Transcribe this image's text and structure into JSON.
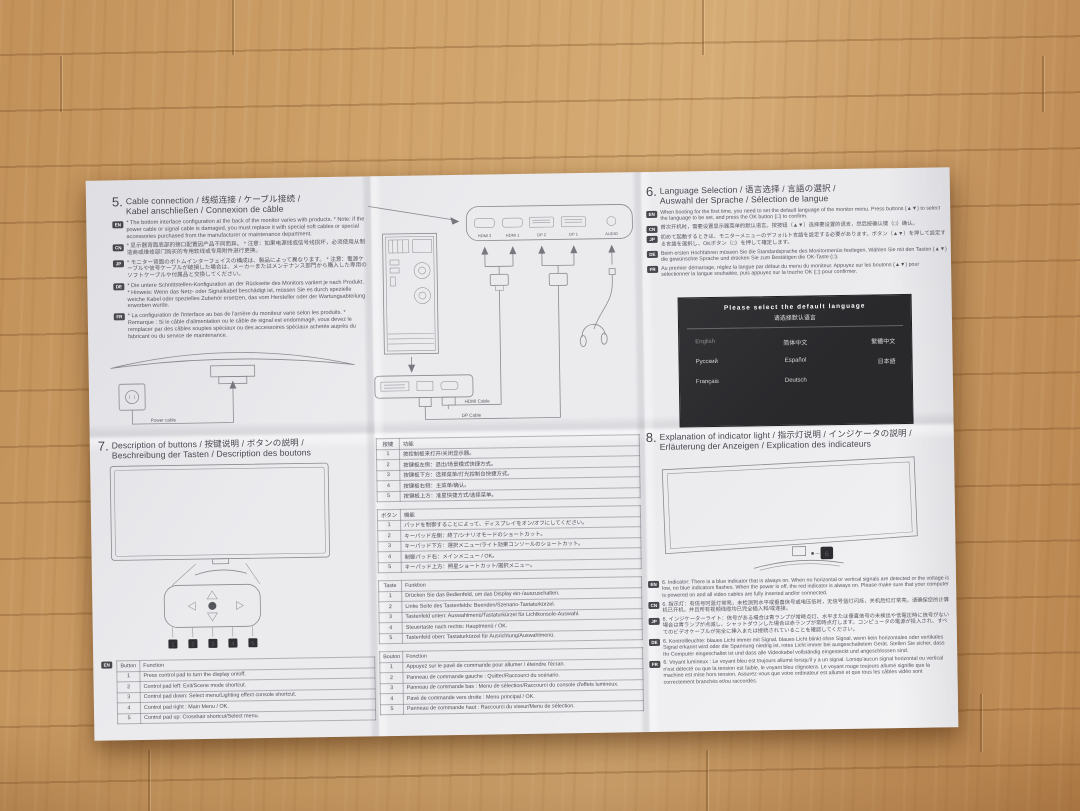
{
  "colors": {
    "wood": "#c79a63",
    "paper": "#ebebee",
    "ink": "#55555e",
    "screen_bg": "#2b2b2d",
    "badge_bg": "#47474d"
  },
  "sections": {
    "cable": {
      "num": "5.",
      "title1": "Cable connection / 线缆连接 / ケーブル接続 /",
      "title2": "Kabel anschließen / Connexion de câble",
      "paragraphs": [
        {
          "lang": "EN",
          "text": "* The bottom interface configuration at the back of the monitor varies with products. * Note: if the power cable or signal cable is damaged, you must replace it with special soft cables or special accessories purchased from the manufacturer or maintenance department."
        },
        {
          "lang": "CN",
          "text": "* 显示器背面底部的接口配置因产品不同而异。 * 注意：如果电源线或信号线损坏，必须使用从制造商或维修部门购买的专用软线或专用附件进行更换。"
        },
        {
          "lang": "JP",
          "text": "* モニター背面のボトムインターフェイスの構成は、製品によって異なります。 * 注意：電源ケーブルや信号ケーブルが破損した場合は、メーカーまたはメンテナンス部門から購入した専用のソフトケーブルや付属品と交換してください。"
        },
        {
          "lang": "DE",
          "text": "* Die untere Schnittstellen-Konfiguration an der Rückseite des Monitors variiert je nach Produkt. * Hinweis: Wenn das Netz- oder Signalkabel beschädigt ist, müssen Sie es durch spezielle weiche Kabel oder spezielles Zubehör ersetzen, das vom Hersteller oder der Wartungsabteilung erworben wurde."
        },
        {
          "lang": "FR",
          "text": "* La configuration de l'interface au bas de l'arrière du moniteur varie selon les produits. * Remarque : Si le câble d'alimentation ou le câble de signal est endommagé, vous devez le remplacer par des câbles souples spéciaux ou des accessoires spéciaux achetés auprès du fabricant ou du service de maintenance."
        }
      ],
      "power_cable_label": "Power cable"
    },
    "diagram": {
      "ports": [
        "HDMI 2",
        "HDMI 1",
        "DP 2",
        "DP 1",
        "AUDIO"
      ],
      "hdmi_cable_label": "HDMI Cable",
      "dp_cable_label": "DP Cable"
    },
    "language": {
      "num": "6.",
      "title1": "Language Selection / 语言选择 / 言語の選択 /",
      "title2": "Auswahl der Sprache / Sélection de langue",
      "paragraphs": [
        {
          "lang": "EN",
          "text": "When booting for the first time, you need to set the default language of the monitor menu. Press buttons (▲▼) to select the language to be set, and press the OK button (□) to confirm."
        },
        {
          "lang": "CN",
          "text": "首次开机时，需要设置显示器菜单的默认语言。按按钮（▲▼）选择要设置的语言，然后按确认键（□）确认。"
        },
        {
          "lang": "JP",
          "text": "初めて起動するときは、モニターメニューのデフォルト言語を設定する必要があります。ボタン（▲▼）を押して設定する言語を選択し、OKボタン（□）を押して確定します。"
        },
        {
          "lang": "DE",
          "text": "Beim ersten Hochfahren müssen Sie die Standardsprache des Monitormenüs festlegen. Wählen Sie mit den Tasten (▲▼) die gewünschte Sprache und drücken Sie zum Bestätigen die OK-Taste (□)."
        },
        {
          "lang": "FR",
          "text": "Au premier démarrage, réglez la langue par défaut du menu du moniteur. Appuyez sur les boutons (▲▼) pour sélectionner la langue souhaitée, puis appuyez sur la touche OK (□) pour confirmer."
        }
      ],
      "screen": {
        "title_en": "Please select the default language",
        "title_cn": "请选择默认语言",
        "options": [
          "English",
          "简体中文",
          "繁體中文",
          "Русский",
          "Español",
          "日本語",
          "Français",
          "Deutsch"
        ]
      }
    },
    "buttons": {
      "num": "7.",
      "title1": "Description of buttons / 按键说明 / ボタンの説明 /",
      "title2": "Beschreibung der Tasten / Description des boutons",
      "pad_numbers": [
        "1",
        "2",
        "3",
        "4",
        "5"
      ],
      "table_en": {
        "lang": "EN",
        "col_button": "Button",
        "col_function": "Function",
        "rows": [
          {
            "n": "1",
            "f": "Press control pad to turn the display on/off."
          },
          {
            "n": "2",
            "f": "Control pad left: Exit/Scene mode shortcut."
          },
          {
            "n": "3",
            "f": "Control pad down: Select menu/Lighting effect console shortcut."
          },
          {
            "n": "4",
            "f": "Control pad right : Main Menu / OK."
          },
          {
            "n": "5",
            "f": "Control pad up: Crosshair shortcut/Select menu."
          }
        ]
      }
    },
    "tables": {
      "cn": {
        "col1": "按键",
        "col2": "功能",
        "rows": [
          {
            "n": "1",
            "f": "按控制板来打开/关闭显示器。"
          },
          {
            "n": "2",
            "f": "按键板左侧：退出/场景模式快捷方式。"
          },
          {
            "n": "3",
            "f": "按键板下方：选择菜单/灯光控制台快捷方式。"
          },
          {
            "n": "4",
            "f": "按键板右侧：主菜单/确认。"
          },
          {
            "n": "5",
            "f": "按键板上方：准星快捷方式/选择菜单。"
          }
        ]
      },
      "jp": {
        "col1": "ボタン",
        "col2": "機能",
        "rows": [
          {
            "n": "1",
            "f": "パッドを制御することによって、ディスプレイをオン/オフにしてください。"
          },
          {
            "n": "2",
            "f": "キーパッド左側：終了/シナリオモードのショートカット。"
          },
          {
            "n": "3",
            "f": "キーパッド下方：選択メニュー/ライト効果コンソールのショートカット。"
          },
          {
            "n": "4",
            "f": "制御パッド右：メインメニュー / OK。"
          },
          {
            "n": "5",
            "f": "キーパッド上方：照星ショートカット/選択メニュー。"
          }
        ]
      },
      "de": {
        "col1": "Taste",
        "col2": "Funktion",
        "rows": [
          {
            "n": "1",
            "f": "Drücken Sie das Bedienfeld, um das Display ein-/auszuschalten."
          },
          {
            "n": "2",
            "f": "Linke Seite des Tastenfelds: Beenden/Szenario-Tastaturkürzel."
          },
          {
            "n": "3",
            "f": "Tastenfeld unten: Auswahlmenü/Tastaturkürzel für Lichtkonsole-Auswahl."
          },
          {
            "n": "4",
            "f": "Steuertaste nach rechts: Hauptmenü / OK."
          },
          {
            "n": "5",
            "f": "Tastenfeld oben: Tastaturkürzel für Ausrichtung/Auswahlmenü."
          }
        ]
      },
      "fr": {
        "col1": "Bouton",
        "col2": "Fonction",
        "rows": [
          {
            "n": "1",
            "f": "Appuyez sur le pavé de commande pour allumer / éteindre l'écran."
          },
          {
            "n": "2",
            "f": "Panneau de commande gauche : Quitter/Raccourci du scénario."
          },
          {
            "n": "3",
            "f": "Panneau de commande bas : Menu de sélection/Raccourci du console d'effets lumineux."
          },
          {
            "n": "4",
            "f": "Pavé de commande vers droite : Menu principal / OK."
          },
          {
            "n": "5",
            "f": "Panneau de commande haut : Raccourci du viseur/Menu de sélection."
          }
        ]
      }
    },
    "indicator": {
      "num": "8.",
      "title1": "Explanation of indicator light / 指示灯说明 / インジケータの説明 /",
      "title2": "Erläuterung der Anzeigen / Explication des indicateurs",
      "marker": "6",
      "paragraphs": [
        {
          "lang": "EN",
          "text": "6. Indicator: There is a blue indicator that is always on. When no horizontal or vertical signals are detected or the voltage is low, no blue indicators flashes. When the power is off, the red indicator is always on. Please make sure that your computer is powered on and all video cables are fully inserted and/or connected."
        },
        {
          "lang": "CN",
          "text": "6. 指示灯：有信号时蓝灯常亮，未检测到水平或垂直信号或电压低时，无信号蓝灯闪烁，关机后红灯常亮。请确保您的计算机已开机，并且所有视频线缆均已完全插入和/或连接。"
        },
        {
          "lang": "JP",
          "text": "6. インジケーターライト：信号がある場合は青ランプが常時点灯、水平または垂直信号の未検出や低電圧時に信号がない場合は青ランプが点滅し、シャットダウンした場合は赤ランプが常時点灯します。コンピュータの電源が投入され、すべてのビデオケーブルが完全に挿入または接続されていることを確認してください。"
        },
        {
          "lang": "DE",
          "text": "6. Kontrollleuchte: blaues Licht immer mit Signal, blaues Licht blinkt ohne Signal, wenn kein horizontales oder vertikales Signal erkannt wird oder die Spannung niedrig ist, rotes Licht immer bei ausgeschaltetem Gerät. Stellen Sie sicher, dass Ihr Computer eingeschaltet ist und dass alle Videokabel vollständig eingesteckt und angeschlossen sind."
        },
        {
          "lang": "FR",
          "text": "6. Voyant lumineux : Le voyant bleu est toujours allumé lorsqu'il y a un signal. Lorsqu'aucun signal horizontal ou vertical n'est détecté ou que la tension est faible, le voyant bleu clignotera. Le voyant rouge toujours allumé signifie que la machine est mise hors tension. Assurez-vous que votre ordinateur est allumé et que tous les câbles vidéo sont correctement branchés et/ou raccordés."
        }
      ]
    }
  }
}
